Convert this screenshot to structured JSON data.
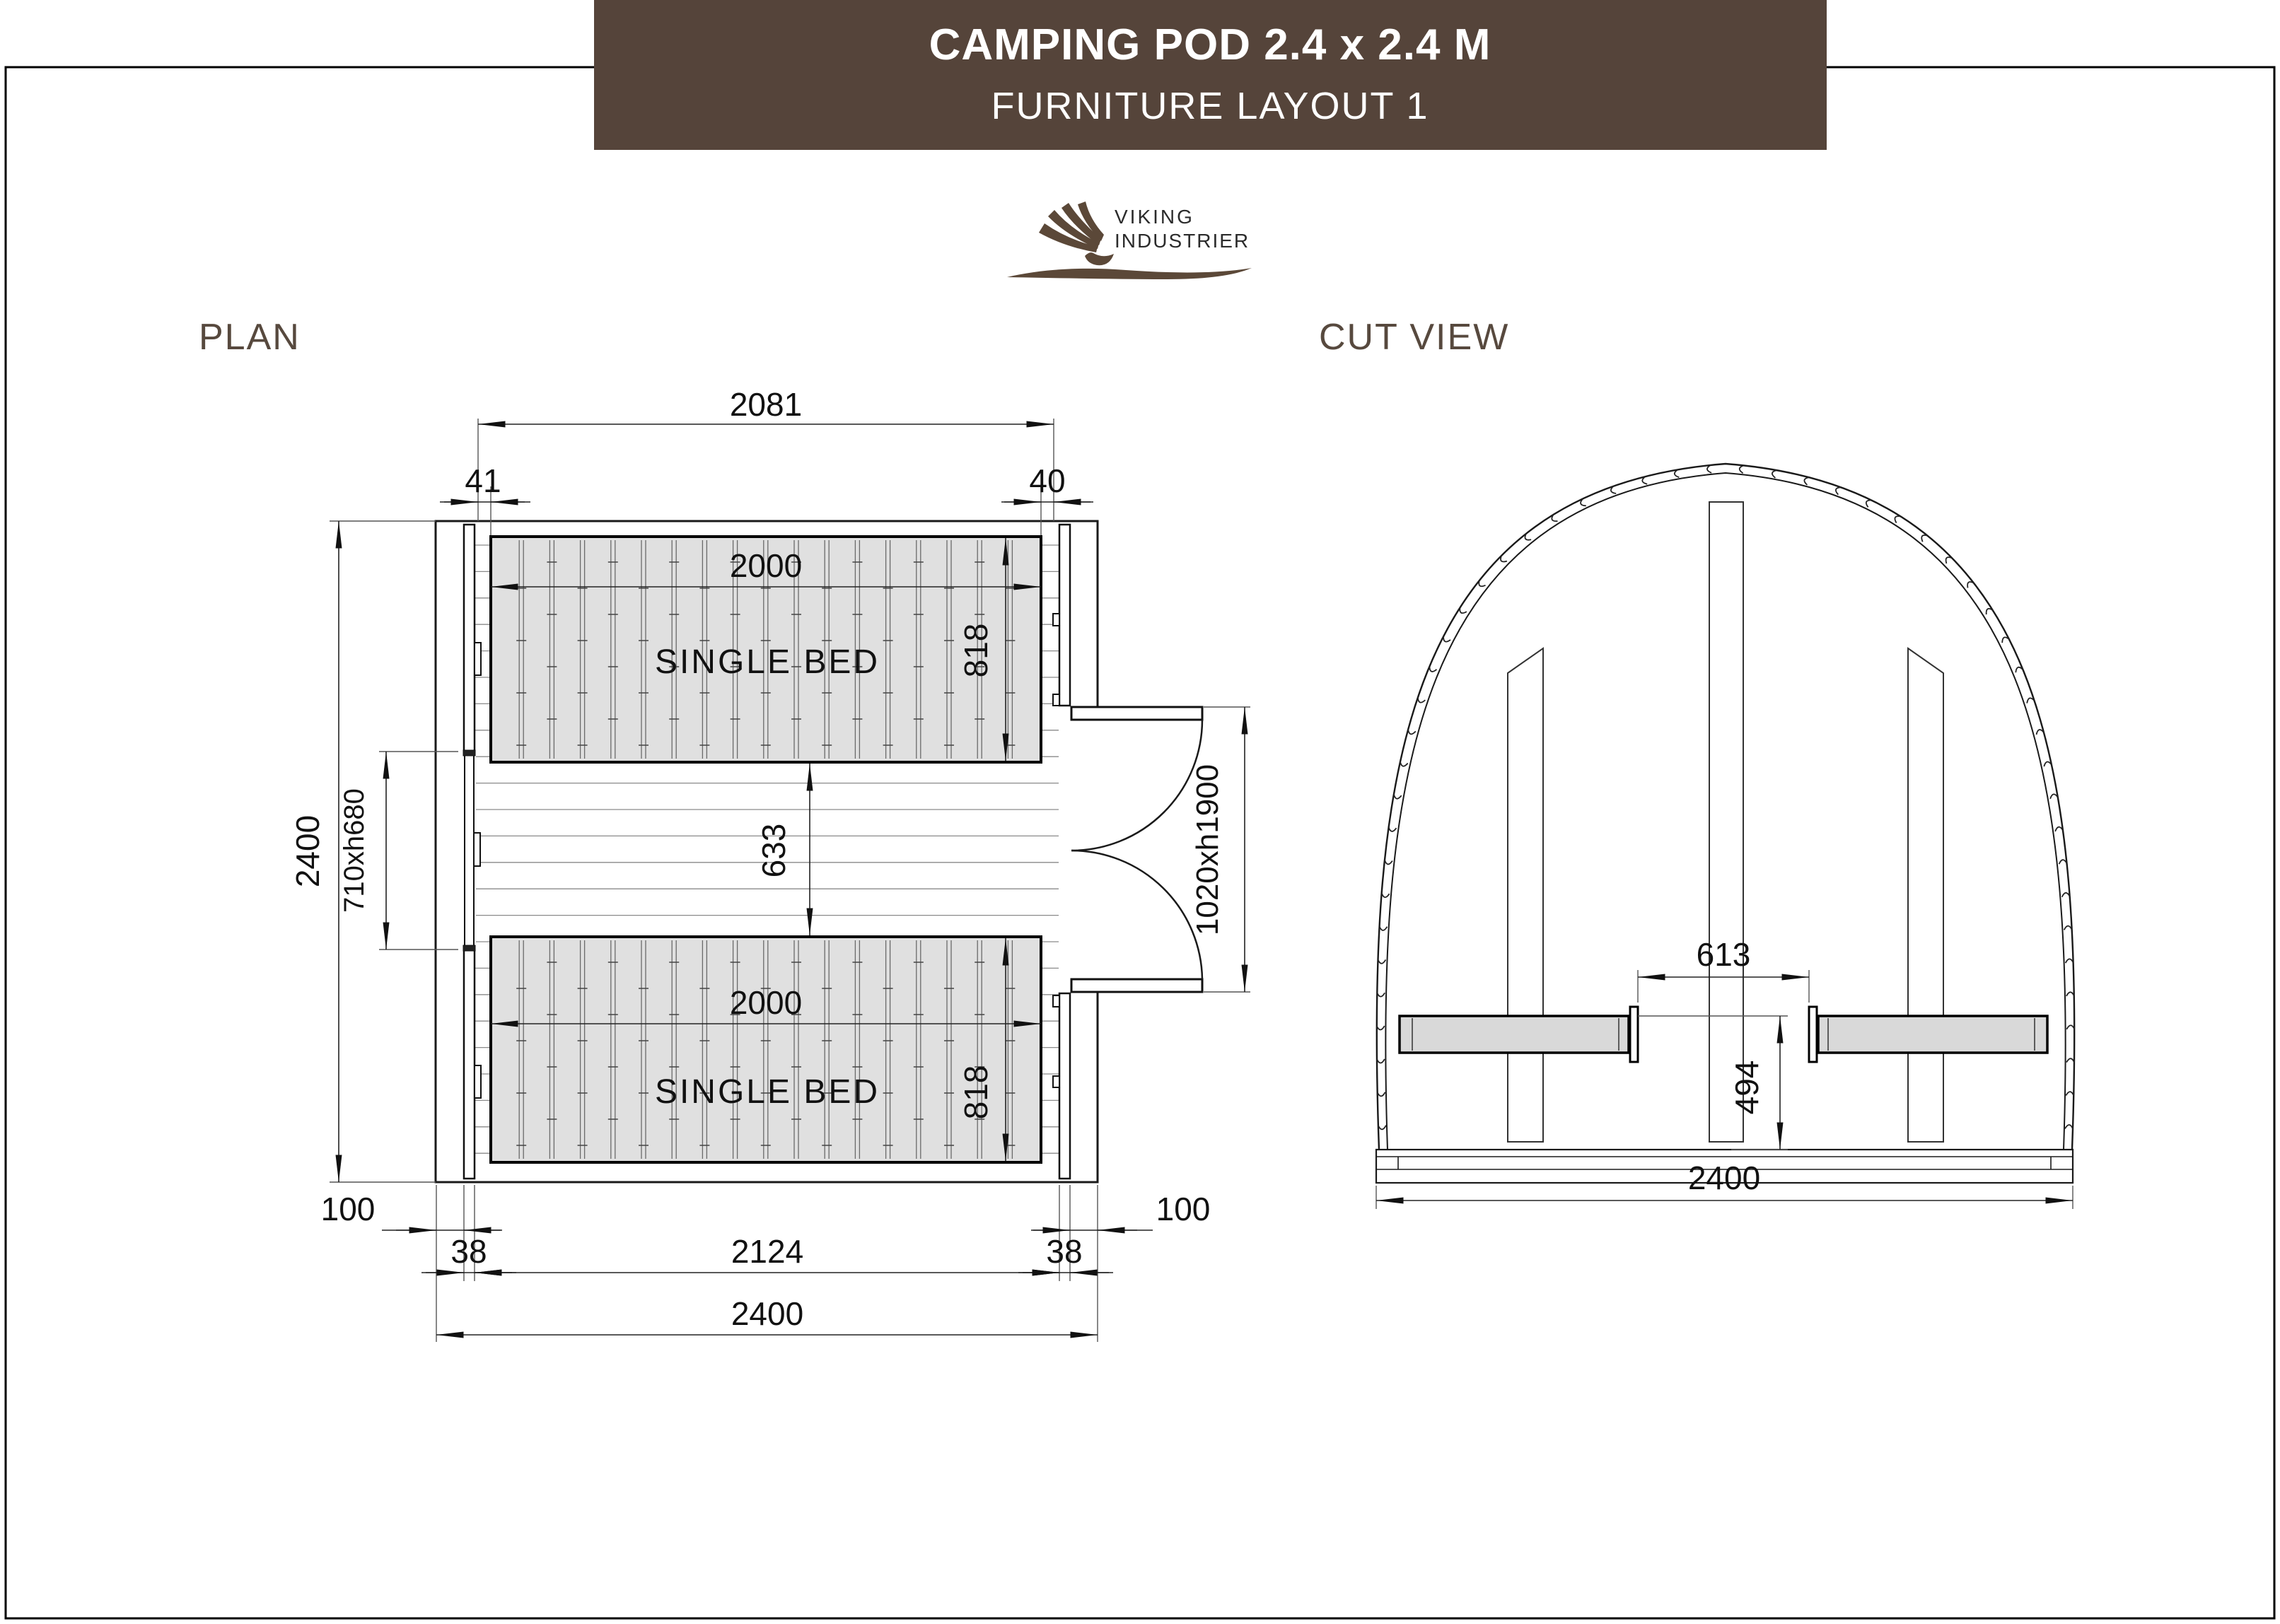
{
  "header": {
    "title": "CAMPING POD 2.4 x 2.4 M",
    "subtitle": "FURNITURE LAYOUT 1",
    "bg_color": "#55443A",
    "text_color": "#FFFFFF"
  },
  "logo": {
    "line1": "VIKING",
    "line2": "INDUSTRIER",
    "accent_color": "#5B4838"
  },
  "views": {
    "plan_label": "PLAN",
    "cut_label": "CUT VIEW"
  },
  "plan": {
    "bed_label": "SINGLE BED",
    "dims": {
      "overall_top": "2081",
      "gap_left": "41",
      "gap_right": "40",
      "height_total": "2400",
      "bed_length": "2000",
      "bed_width": "818",
      "between_beds": "633",
      "window": "710xh680",
      "door": "1020xh1900",
      "offset_left": "100",
      "offset_right": "100",
      "wall_left": "38",
      "wall_right": "38",
      "interior_width": "2124",
      "width_total": "2400"
    }
  },
  "cut": {
    "dims": {
      "beds_gap": "613",
      "platform_height": "494",
      "width_total": "2400"
    }
  },
  "colors": {
    "bed_fill": "#E0E0E0",
    "board_fill": "#D9D9D9",
    "line": "#1A1A1A"
  }
}
